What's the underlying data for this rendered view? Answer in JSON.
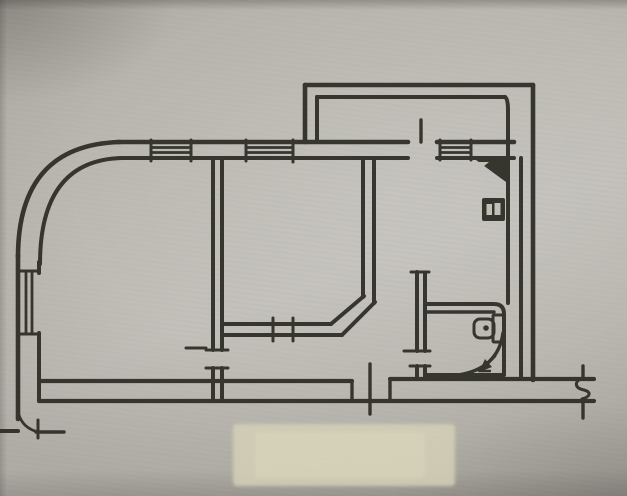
{
  "meta": {
    "description": "hand-drawn apartment floor plan, ink on paper (photograph of a sketch)",
    "visible_text": "none",
    "canvas": {
      "width": 627,
      "height": 496
    }
  },
  "colors": {
    "ink": "#2f2d28",
    "paper_mid": "#bcbab2",
    "paper_patch": "#d7d2b8",
    "paper_light": "#c3c0b5"
  },
  "drawing": {
    "default_stroke_width": 4,
    "elements": [
      {
        "name": "paper-patch",
        "type": "rect",
        "x": 233,
        "y": 424,
        "width": 222,
        "height": 62,
        "rx": 4,
        "fill": "#d7d2b8",
        "opacity": 0.8,
        "blur": true
      },
      {
        "name": "paper-patch-core",
        "type": "rect",
        "x": 255,
        "y": 432,
        "width": 170,
        "height": 46,
        "rx": 4,
        "fill": "#dad5bc",
        "opacity": 0.55,
        "blur": true
      },
      {
        "name": "curved-wall-outer",
        "type": "path",
        "d": "M 18 257 Q 18 145 120 142",
        "w": 4.6
      },
      {
        "name": "curved-wall-inner",
        "type": "path",
        "d": "M 40 264 Q 40 160 122 158",
        "w": 4
      },
      {
        "name": "top-wall-outer-left",
        "type": "line",
        "x1": 118,
        "y1": 142,
        "x2": 408,
        "y2": 142,
        "w": 4.6
      },
      {
        "name": "top-wall-outer-right",
        "type": "line",
        "x1": 437,
        "y1": 142,
        "x2": 514,
        "y2": 142,
        "w": 4.6
      },
      {
        "name": "top-wall-inner-left",
        "type": "line",
        "x1": 120,
        "y1": 158,
        "x2": 408,
        "y2": 158,
        "w": 4
      },
      {
        "name": "top-wall-inner-right",
        "type": "line",
        "x1": 437,
        "y1": 158,
        "x2": 514,
        "y2": 158,
        "w": 4
      },
      {
        "name": "window-1-pane-line",
        "type": "line",
        "x1": 151,
        "y1": 147.5,
        "x2": 191,
        "y2": 147.5,
        "w": 2.8
      },
      {
        "name": "window-1-pane-line",
        "type": "line",
        "x1": 151,
        "y1": 152.5,
        "x2": 191,
        "y2": 152.5,
        "w": 2.8
      },
      {
        "name": "window-1-jamb",
        "type": "line",
        "x1": 151,
        "y1": 140,
        "x2": 151,
        "y2": 161,
        "w": 3
      },
      {
        "name": "window-1-jamb",
        "type": "line",
        "x1": 191,
        "y1": 140,
        "x2": 191,
        "y2": 161,
        "w": 3
      },
      {
        "name": "window-2-pane-line",
        "type": "line",
        "x1": 246,
        "y1": 147.5,
        "x2": 293,
        "y2": 147.5,
        "w": 2.8
      },
      {
        "name": "window-2-pane-line",
        "type": "line",
        "x1": 246,
        "y1": 152.5,
        "x2": 293,
        "y2": 152.5,
        "w": 2.8
      },
      {
        "name": "window-2-jamb",
        "type": "line",
        "x1": 246,
        "y1": 140,
        "x2": 246,
        "y2": 161,
        "w": 3
      },
      {
        "name": "window-2-jamb",
        "type": "line",
        "x1": 293,
        "y1": 140,
        "x2": 293,
        "y2": 162,
        "w": 3
      },
      {
        "name": "balcony-door-leaf",
        "type": "line",
        "x1": 421,
        "y1": 120,
        "x2": 421,
        "y2": 142,
        "w": 3.4
      },
      {
        "name": "window-3-pane-line",
        "type": "line",
        "x1": 440,
        "y1": 147.5,
        "x2": 471,
        "y2": 147.5,
        "w": 2.8
      },
      {
        "name": "window-3-pane-line",
        "type": "line",
        "x1": 440,
        "y1": 152.5,
        "x2": 471,
        "y2": 152.5,
        "w": 2.8
      },
      {
        "name": "window-3-jamb",
        "type": "line",
        "x1": 440,
        "y1": 140,
        "x2": 440,
        "y2": 160,
        "w": 3
      },
      {
        "name": "window-3-jamb",
        "type": "line",
        "x1": 471,
        "y1": 140,
        "x2": 471,
        "y2": 160,
        "w": 3
      },
      {
        "name": "balcony-wall-left-outer",
        "type": "line",
        "x1": 305,
        "y1": 85,
        "x2": 305,
        "y2": 142,
        "w": 4.6
      },
      {
        "name": "balcony-wall-left-inner",
        "type": "line",
        "x1": 317,
        "y1": 97,
        "x2": 317,
        "y2": 142,
        "w": 4
      },
      {
        "name": "balcony-wall-top-outer",
        "type": "line",
        "x1": 305,
        "y1": 85,
        "x2": 533,
        "y2": 85,
        "w": 4.6
      },
      {
        "name": "balcony-wall-top-inner",
        "type": "line",
        "x1": 317,
        "y1": 97,
        "x2": 505,
        "y2": 97,
        "w": 4
      },
      {
        "name": "balcony-right-inner-wall",
        "type": "path",
        "d": "M 505 97 Q 508 99 508 110 L 508 303",
        "w": 4
      },
      {
        "name": "right-wall-outer",
        "type": "line",
        "x1": 533,
        "y1": 85,
        "x2": 533,
        "y2": 380,
        "w": 4.6
      },
      {
        "name": "right-wall-inner",
        "type": "line",
        "x1": 521,
        "y1": 158,
        "x2": 521,
        "y2": 379,
        "w": 4
      },
      {
        "name": "left-wall-outer",
        "type": "line",
        "x1": 18,
        "y1": 255,
        "x2": 18,
        "y2": 419,
        "w": 4.6
      },
      {
        "name": "left-wall-inner",
        "type": "line",
        "x1": 39,
        "y1": 262,
        "x2": 39,
        "y2": 273,
        "w": 4
      },
      {
        "name": "left-wall-inner",
        "type": "line",
        "x1": 39,
        "y1": 333,
        "x2": 39,
        "y2": 401,
        "w": 4
      },
      {
        "name": "window-left-cap",
        "type": "line",
        "x1": 18,
        "y1": 271,
        "x2": 39,
        "y2": 271,
        "w": 3
      },
      {
        "name": "window-left-cap",
        "type": "line",
        "x1": 18,
        "y1": 334,
        "x2": 39,
        "y2": 334,
        "w": 3
      },
      {
        "name": "window-left-pane-line",
        "type": "line",
        "x1": 26,
        "y1": 271,
        "x2": 26,
        "y2": 334,
        "w": 2.8
      },
      {
        "name": "window-left-pane-line",
        "type": "line",
        "x1": 32,
        "y1": 271,
        "x2": 32,
        "y2": 334,
        "w": 2.8
      },
      {
        "name": "south-wall-inner",
        "type": "line",
        "x1": 39,
        "y1": 381,
        "x2": 352,
        "y2": 381,
        "w": 4.2
      },
      {
        "name": "south-door-jamb",
        "type": "line",
        "x1": 352,
        "y1": 381,
        "x2": 352,
        "y2": 401,
        "w": 3.4
      },
      {
        "name": "south-door-post",
        "type": "line",
        "x1": 370,
        "y1": 364,
        "x2": 370,
        "y2": 414,
        "w": 3.4
      },
      {
        "name": "south-door-jamb",
        "type": "line",
        "x1": 390,
        "y1": 379,
        "x2": 390,
        "y2": 401,
        "w": 3.4
      },
      {
        "name": "south-wall-inner-right",
        "type": "line",
        "x1": 390,
        "y1": 379,
        "x2": 594,
        "y2": 379,
        "w": 4.2
      },
      {
        "name": "south-wall-outer",
        "type": "line",
        "x1": 39,
        "y1": 401,
        "x2": 594,
        "y2": 401,
        "w": 4.2
      },
      {
        "name": "entrance-wall-stub",
        "type": "line",
        "x1": 0,
        "y1": 431,
        "x2": 18,
        "y2": 431,
        "w": 4
      },
      {
        "name": "entrance-door-arc",
        "type": "path",
        "d": "M 19 415 Q 23 428 38 432",
        "w": 2.8
      },
      {
        "name": "entrance-door-leaf",
        "type": "line",
        "x1": 36,
        "y1": 432,
        "x2": 64,
        "y2": 432,
        "w": 3.4
      },
      {
        "name": "entrance-door-tick",
        "type": "line",
        "x1": 38,
        "y1": 420,
        "x2": 38,
        "y2": 438,
        "w": 3
      },
      {
        "name": "room-divider-wall",
        "type": "line",
        "x1": 213,
        "y1": 158,
        "x2": 213,
        "y2": 350,
        "w": 4
      },
      {
        "name": "room-divider-wall",
        "type": "line",
        "x1": 222,
        "y1": 158,
        "x2": 222,
        "y2": 350,
        "w": 4
      },
      {
        "name": "room-divider-wall",
        "type": "line",
        "x1": 213,
        "y1": 368,
        "x2": 213,
        "y2": 401,
        "w": 4
      },
      {
        "name": "room-divider-wall",
        "type": "line",
        "x1": 222,
        "y1": 368,
        "x2": 222,
        "y2": 401,
        "w": 4
      },
      {
        "name": "room1-door-jamb",
        "type": "line",
        "x1": 206,
        "y1": 350,
        "x2": 228,
        "y2": 350,
        "w": 3
      },
      {
        "name": "room1-door-jamb",
        "type": "line",
        "x1": 206,
        "y1": 368,
        "x2": 228,
        "y2": 368,
        "w": 3
      },
      {
        "name": "room1-door-leaf",
        "type": "line",
        "x1": 186,
        "y1": 348,
        "x2": 206,
        "y2": 348,
        "w": 3
      },
      {
        "name": "midroom-south-wall",
        "type": "line",
        "x1": 222,
        "y1": 324,
        "x2": 331,
        "y2": 324,
        "w": 4
      },
      {
        "name": "midroom-south-wall",
        "type": "line",
        "x1": 222,
        "y1": 335,
        "x2": 342,
        "y2": 335,
        "w": 4
      },
      {
        "name": "midroom-door-jamb",
        "type": "line",
        "x1": 273,
        "y1": 318,
        "x2": 273,
        "y2": 341,
        "w": 3
      },
      {
        "name": "midroom-door-jamb",
        "type": "line",
        "x1": 293,
        "y1": 318,
        "x2": 293,
        "y2": 341,
        "w": 3
      },
      {
        "name": "chamfer-wall-outer",
        "type": "line",
        "x1": 331,
        "y1": 324,
        "x2": 364,
        "y2": 296,
        "w": 4
      },
      {
        "name": "chamfer-wall-inner",
        "type": "line",
        "x1": 342,
        "y1": 335,
        "x2": 375,
        "y2": 302,
        "w": 4
      },
      {
        "name": "kitchen-wall-outer",
        "type": "line",
        "x1": 363,
        "y1": 158,
        "x2": 363,
        "y2": 297,
        "w": 4
      },
      {
        "name": "kitchen-wall-inner",
        "type": "line",
        "x1": 374,
        "y1": 158,
        "x2": 374,
        "y2": 303,
        "w": 4
      },
      {
        "name": "bath-wall-cap",
        "type": "line",
        "x1": 411,
        "y1": 272,
        "x2": 429,
        "y2": 272,
        "w": 3
      },
      {
        "name": "bath-wall",
        "type": "line",
        "x1": 417,
        "y1": 272,
        "x2": 417,
        "y2": 351,
        "w": 4
      },
      {
        "name": "bath-wall",
        "type": "line",
        "x1": 425,
        "y1": 274,
        "x2": 425,
        "y2": 351,
        "w": 4
      },
      {
        "name": "bath-wall",
        "type": "line",
        "x1": 417,
        "y1": 366,
        "x2": 417,
        "y2": 379,
        "w": 4
      },
      {
        "name": "bath-wall",
        "type": "line",
        "x1": 425,
        "y1": 366,
        "x2": 425,
        "y2": 379,
        "w": 4
      },
      {
        "name": "bath-door-jamb",
        "type": "line",
        "x1": 404,
        "y1": 351,
        "x2": 430,
        "y2": 351,
        "w": 3
      },
      {
        "name": "bath-door-jamb",
        "type": "line",
        "x1": 410,
        "y1": 366,
        "x2": 430,
        "y2": 366,
        "w": 3
      },
      {
        "name": "bathroom-box-outer",
        "type": "path",
        "d": "M 425 304 L 494 304 Q 504 304 504 314 L 504 374",
        "w": 4
      },
      {
        "name": "bathroom-box-inner-top",
        "type": "line",
        "x1": 425,
        "y1": 312,
        "x2": 494,
        "y2": 312,
        "w": 3.4
      },
      {
        "name": "bathroom-box-bottom",
        "type": "line",
        "x1": 425,
        "y1": 375,
        "x2": 504,
        "y2": 375,
        "w": 4
      },
      {
        "name": "toilet-tank-icon",
        "type": "rect",
        "x": 493,
        "y": 315,
        "width": 11,
        "height": 27,
        "rx": 1,
        "stroke": true,
        "w": 3
      },
      {
        "name": "toilet-bowl-icon",
        "type": "rect",
        "x": 474,
        "y": 319,
        "width": 20,
        "height": 19,
        "rx": 6,
        "stroke": true,
        "w": 3
      },
      {
        "name": "toilet-dot-icon",
        "type": "circle",
        "cx": 486,
        "cy": 328,
        "r": 2.8,
        "fill": "ink"
      },
      {
        "name": "shower-arc-icon",
        "type": "path",
        "d": "M 458 375 Q 498 369 503 333",
        "w": 3.4
      },
      {
        "name": "shower-arrow-icon",
        "type": "line",
        "x1": 495,
        "y1": 356,
        "x2": 485,
        "y2": 366,
        "w": 2.8
      },
      {
        "name": "shower-arrow-head-icon",
        "type": "polygon",
        "points": "479,372 492,367 485,359",
        "fill": "ink"
      },
      {
        "name": "shower-arrow-tick-icon",
        "type": "line",
        "x1": 479,
        "y1": 371,
        "x2": 490,
        "y2": 371,
        "w": 2.4
      },
      {
        "name": "vent-shaft-icon",
        "type": "polygon",
        "points": "476,160 506,160 506,182",
        "fill": "ink"
      },
      {
        "name": "vent-shaft-notch",
        "type": "polygon",
        "points": "478,162 489,162 478,171",
        "fill": "paper"
      },
      {
        "name": "heater-box-icon",
        "type": "rect",
        "x": 482,
        "y": 198,
        "width": 23,
        "height": 23,
        "rx": 2,
        "fill": "ink"
      },
      {
        "name": "heater-mark",
        "type": "rect",
        "x": 486.5,
        "y": 204,
        "width": 5.5,
        "height": 11,
        "fill": "paper"
      },
      {
        "name": "heater-mark",
        "type": "rect",
        "x": 494.5,
        "y": 203,
        "width": 6,
        "height": 12,
        "fill": "paper"
      },
      {
        "name": "break-mark-upper",
        "type": "line",
        "x1": 583,
        "y1": 366,
        "x2": 583,
        "y2": 378,
        "w": 3.4
      },
      {
        "name": "break-mark-squiggle",
        "type": "path",
        "d": "M 583 378 C 574 381 574 388 584 390 C 592 392 590 397 582 399",
        "w": 3
      },
      {
        "name": "break-mark-lower",
        "type": "line",
        "x1": 583,
        "y1": 399,
        "x2": 583,
        "y2": 418,
        "w": 3.4
      }
    ]
  }
}
